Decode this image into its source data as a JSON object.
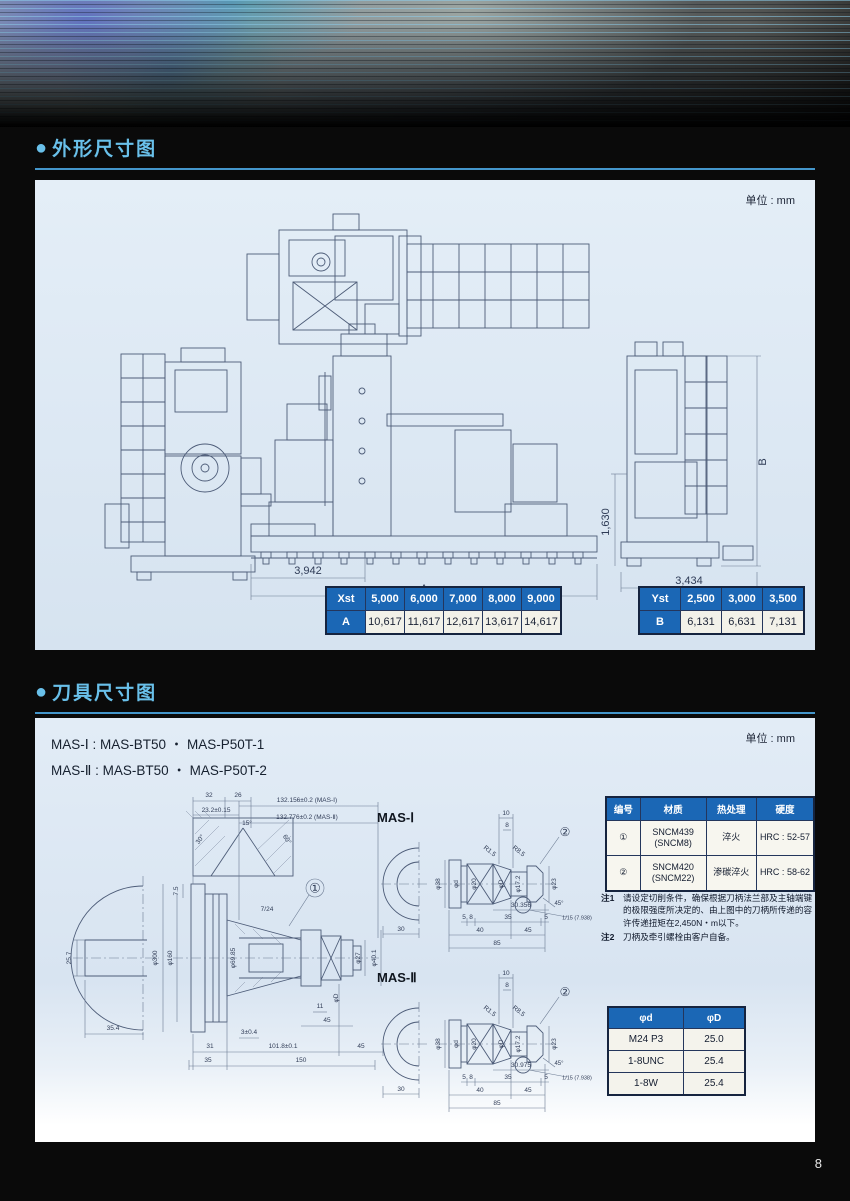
{
  "page": {
    "number": "8"
  },
  "colors": {
    "accent": "#69c0ea",
    "table_header_blue": "#1b67b5",
    "panel_bg": "#dfe9f3"
  },
  "sections": {
    "outline": {
      "bullet": "●",
      "title": "外形尺寸图",
      "unit": "单位 : mm"
    },
    "tools": {
      "bullet": "●",
      "title": "刀具尺寸图",
      "unit": "单位 : mm"
    }
  },
  "outline_drawing": {
    "dims": {
      "partial_length": "3,942",
      "total_length": "A",
      "partial_height": "1,630",
      "total_height": "B",
      "depth": "3,434"
    }
  },
  "dim_table_a": {
    "corner": "Xst",
    "header": [
      "5,000",
      "6,000",
      "7,000",
      "8,000",
      "9,000"
    ],
    "row_label": "A",
    "values": [
      "10,617",
      "11,617",
      "12,617",
      "13,617",
      "14,617"
    ]
  },
  "dim_table_b": {
    "corner": "Yst",
    "header": [
      "2,500",
      "3,000",
      "3,500"
    ],
    "row_label": "B",
    "values": [
      "6,131",
      "6,631",
      "7,131"
    ]
  },
  "tool_section": {
    "mas_lines": [
      "MAS-Ⅰ : MAS-BT50 ・ MAS-P50T-1",
      "MAS-Ⅱ : MAS-BT50 ・ MAS-P50T-2"
    ],
    "mas1_label": "MAS-Ⅰ",
    "mas2_label": "MAS-Ⅱ"
  },
  "material_table": {
    "headers": [
      "编号",
      "材质",
      "热处理",
      "硬度"
    ],
    "rows": [
      {
        "no": "①",
        "material": "SNCM439\n(SNCM8)",
        "treatment": "淬火",
        "hardness": "HRC : 52-57"
      },
      {
        "no": "②",
        "material": "SNCM420\n(SNCM22)",
        "treatment": "渗碳淬火",
        "hardness": "HRC : 58-62"
      }
    ]
  },
  "notes": [
    {
      "label": "注1",
      "text": "请设定切削条件，确保根据刀柄法兰部及主轴端键的极限强度所决定的、由上图中的刀柄所传递的容许传递扭矩在2,450N・m以下。"
    },
    {
      "label": "注2",
      "text": "刀柄及牵引螺栓由客户自备。"
    }
  ],
  "thread_table": {
    "headers": [
      "φd",
      "φD"
    ],
    "rows": [
      [
        "M24 P3",
        "25.0"
      ],
      [
        "1-8UNC",
        "25.4"
      ],
      [
        "1-8W",
        "25.4"
      ]
    ]
  },
  "labels": {
    "big": [
      {
        "t": "32",
        "x": 166,
        "y": 8
      },
      {
        "t": "26",
        "x": 195,
        "y": 8
      },
      {
        "t": "23.2±0.15",
        "x": 173,
        "y": 23
      },
      {
        "t": "132.156±0.2 (MAS-Ⅰ)",
        "x": 264,
        "y": 13
      },
      {
        "t": "132.776±0.2 (MAS-Ⅱ)",
        "x": 264,
        "y": 30
      },
      {
        "t": "30°",
        "x": 158,
        "y": 52,
        "r": -55
      },
      {
        "t": "15°",
        "x": 204,
        "y": 36
      },
      {
        "t": "60°",
        "x": 243,
        "y": 52,
        "r": 55
      },
      {
        "t": "7.5",
        "x": 134,
        "y": 103,
        "r": -90
      },
      {
        "t": "7/24",
        "x": 224,
        "y": 122
      },
      {
        "t": "①",
        "x": 272,
        "y": 100,
        "s": 13
      },
      {
        "t": "φ300",
        "x": 113,
        "y": 170,
        "r": -90
      },
      {
        "t": "φ160",
        "x": 128,
        "y": 170,
        "r": -90
      },
      {
        "t": "φ69.85",
        "x": 191,
        "y": 170,
        "r": -90
      },
      {
        "t": "φ27",
        "x": 316,
        "y": 170,
        "r": -90
      },
      {
        "t": "φ40.1",
        "x": 332,
        "y": 170,
        "r": -90
      },
      {
        "t": "φD",
        "x": 294,
        "y": 210,
        "r": -90
      },
      {
        "t": "25.7",
        "x": 27,
        "y": 170,
        "r": -90
      },
      {
        "t": "35.4",
        "x": 70,
        "y": 241
      },
      {
        "t": "11",
        "x": 277,
        "y": 219
      },
      {
        "t": "45",
        "x": 284,
        "y": 233
      },
      {
        "t": "3±0.4",
        "x": 206,
        "y": 245
      },
      {
        "t": "31",
        "x": 167,
        "y": 259
      },
      {
        "t": "101.8±0.1",
        "x": 240,
        "y": 259
      },
      {
        "t": "45",
        "x": 318,
        "y": 259
      },
      {
        "t": "35",
        "x": 165,
        "y": 273
      },
      {
        "t": "150",
        "x": 258,
        "y": 273
      }
    ],
    "mas1": [
      {
        "t": "10",
        "x": 135,
        "y": 8
      },
      {
        "t": "8",
        "x": 136,
        "y": 20
      },
      {
        "t": "②",
        "x": 194,
        "y": 26,
        "s": 12
      },
      {
        "t": "φ38",
        "x": 68,
        "y": 78,
        "r": -90
      },
      {
        "t": "φd",
        "x": 86,
        "y": 78,
        "r": -90
      },
      {
        "t": "φ20",
        "x": 104,
        "y": 78,
        "r": -90
      },
      {
        "t": "φD",
        "x": 131,
        "y": 78,
        "r": -90
      },
      {
        "t": "φ17.2",
        "x": 148,
        "y": 78,
        "r": -90
      },
      {
        "t": "φ23",
        "x": 184,
        "y": 78,
        "r": -90
      },
      {
        "t": "R8.5",
        "x": 147,
        "y": 46,
        "r": 38
      },
      {
        "t": "R1.5",
        "x": 118,
        "y": 46,
        "r": 38
      },
      {
        "t": "45°",
        "x": 188,
        "y": 98,
        "s": 6
      },
      {
        "t": "30.356",
        "x": 150,
        "y": 100
      },
      {
        "t": "5",
        "x": 93,
        "y": 112
      },
      {
        "t": "8",
        "x": 100,
        "y": 112
      },
      {
        "t": "35",
        "x": 137,
        "y": 112
      },
      {
        "t": "5",
        "x": 175,
        "y": 112
      },
      {
        "t": "1/15 (7.938)",
        "x": 206,
        "y": 113,
        "s": 5.5
      },
      {
        "t": "40",
        "x": 109,
        "y": 125
      },
      {
        "t": "45",
        "x": 157,
        "y": 125
      },
      {
        "t": "85",
        "x": 126,
        "y": 138
      },
      {
        "t": "30",
        "x": 30,
        "y": 124
      }
    ],
    "mas2": [
      {
        "t": "10",
        "x": 135,
        "y": 8
      },
      {
        "t": "8",
        "x": 136,
        "y": 20
      },
      {
        "t": "②",
        "x": 194,
        "y": 26,
        "s": 12
      },
      {
        "t": "φ38",
        "x": 68,
        "y": 78,
        "r": -90
      },
      {
        "t": "φd",
        "x": 86,
        "y": 78,
        "r": -90
      },
      {
        "t": "φ20",
        "x": 104,
        "y": 78,
        "r": -90
      },
      {
        "t": "φD",
        "x": 131,
        "y": 78,
        "r": -90
      },
      {
        "t": "φ17.2",
        "x": 148,
        "y": 78,
        "r": -90
      },
      {
        "t": "φ23",
        "x": 184,
        "y": 78,
        "r": -90
      },
      {
        "t": "R8.5",
        "x": 147,
        "y": 46,
        "r": 38
      },
      {
        "t": "R1.5",
        "x": 118,
        "y": 46,
        "r": 38
      },
      {
        "t": "45°",
        "x": 188,
        "y": 98,
        "s": 6
      },
      {
        "t": "30.975",
        "x": 150,
        "y": 100
      },
      {
        "t": "5",
        "x": 93,
        "y": 112
      },
      {
        "t": "8",
        "x": 100,
        "y": 112
      },
      {
        "t": "35",
        "x": 137,
        "y": 112
      },
      {
        "t": "5",
        "x": 175,
        "y": 112
      },
      {
        "t": "1/15 (7.938)",
        "x": 206,
        "y": 113,
        "s": 5.5
      },
      {
        "t": "40",
        "x": 109,
        "y": 125
      },
      {
        "t": "45",
        "x": 157,
        "y": 125
      },
      {
        "t": "85",
        "x": 126,
        "y": 138
      },
      {
        "t": "30",
        "x": 30,
        "y": 124
      }
    ]
  }
}
